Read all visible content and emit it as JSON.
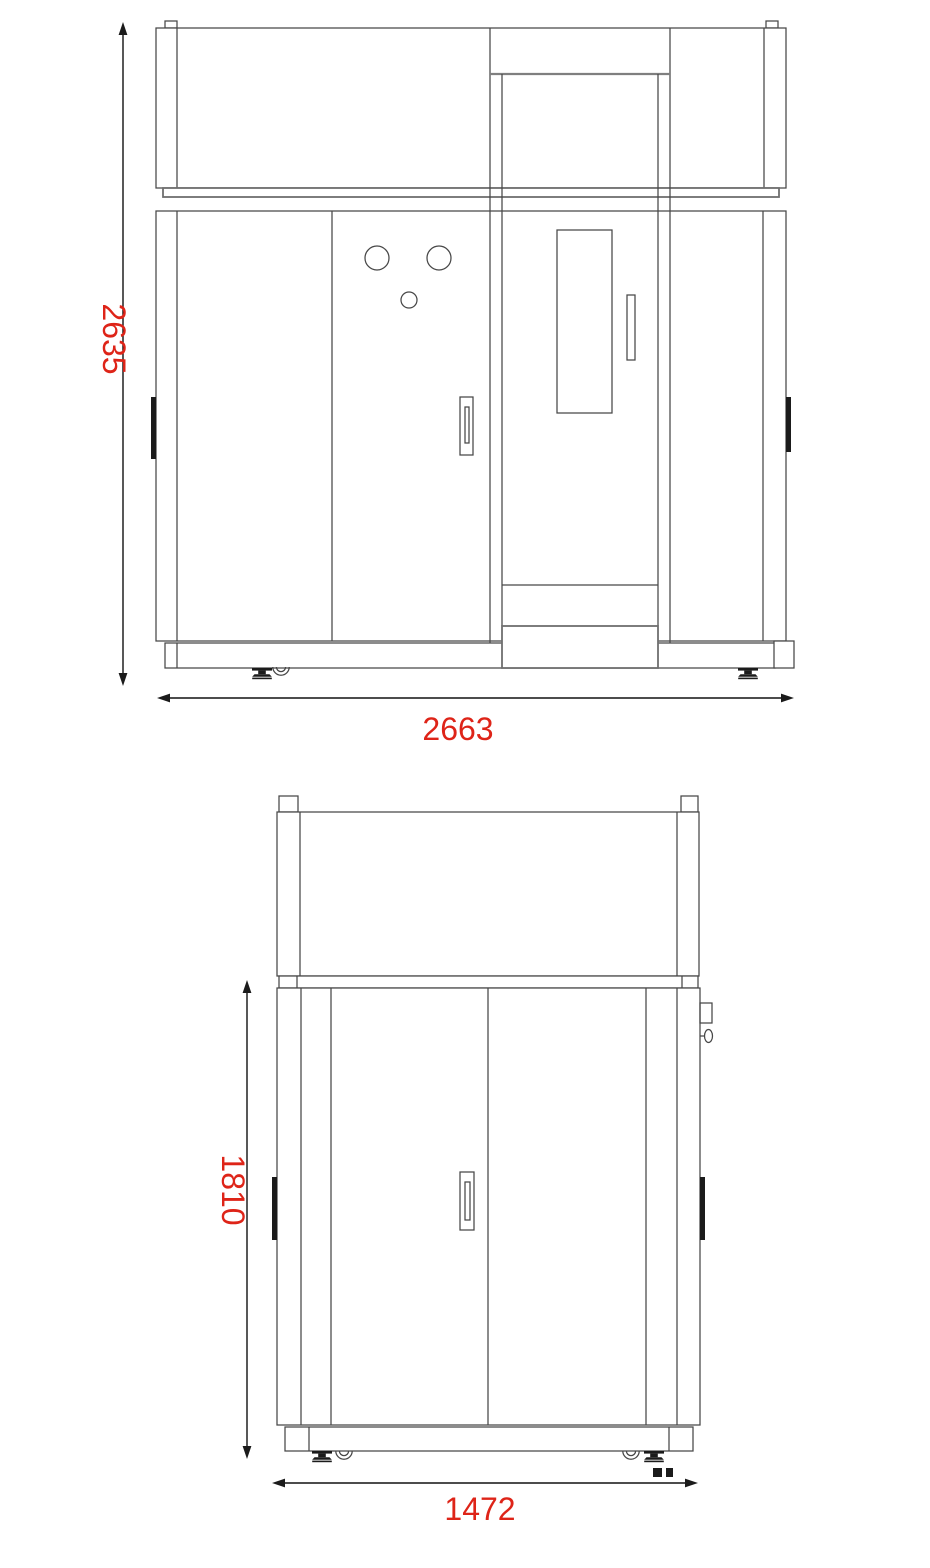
{
  "drawing": {
    "front_view": {
      "height_label": "2635",
      "width_label": "2663"
    },
    "side_view": {
      "height_label": "1810",
      "width_label": "1472"
    }
  },
  "colors": {
    "dimension_text": "#de2418",
    "line": "#474747",
    "dark_fill": "#1b1b1b",
    "background": "#ffffff"
  }
}
